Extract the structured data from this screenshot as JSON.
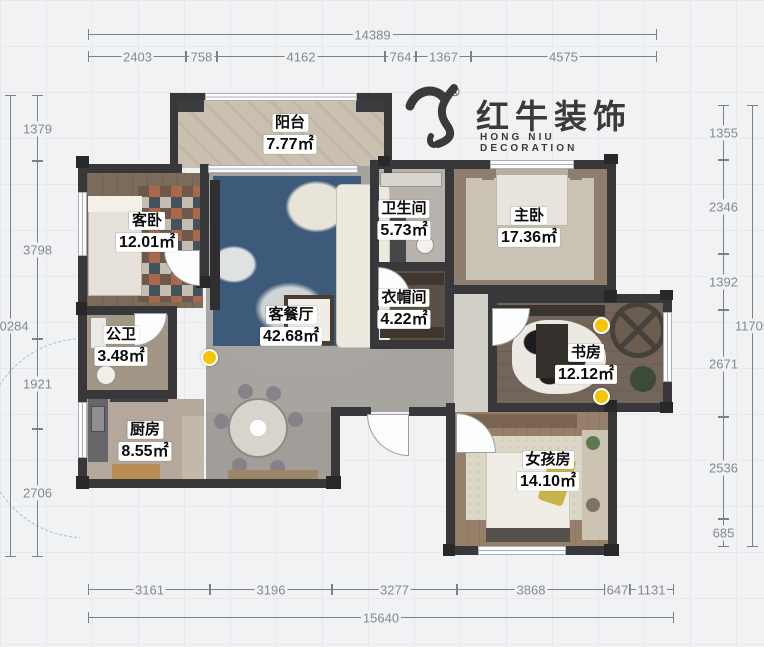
{
  "logo": {
    "brand": "红牛装饰",
    "subtitle": "HONG NIU DECORATION",
    "registered_mark": "®",
    "color": "#3a3a3c"
  },
  "rooms": [
    {
      "name": "阳台",
      "area": "7.77㎡"
    },
    {
      "name": "客卧",
      "area": "12.01㎡"
    },
    {
      "name": "客餐厅",
      "area": "42.68㎡"
    },
    {
      "name": "卫生间",
      "area": "5.73㎡"
    },
    {
      "name": "主卧",
      "area": "17.36㎡"
    },
    {
      "name": "衣帽间",
      "area": "4.22㎡"
    },
    {
      "name": "公卫",
      "area": "3.48㎡"
    },
    {
      "name": "书房",
      "area": "12.12㎡"
    },
    {
      "name": "厨房",
      "area": "8.55㎡"
    },
    {
      "name": "女孩房",
      "area": "14.10㎡"
    }
  ],
  "dimensions": {
    "top": {
      "total": "14389",
      "segments": [
        "2403",
        "758",
        "4162",
        "764",
        "1367",
        "4575"
      ]
    },
    "bottom": {
      "total": "15640",
      "segments": [
        "3161",
        "3196",
        "3277",
        "3868",
        "647",
        "1131"
      ]
    },
    "left": {
      "total": "10284",
      "segments": [
        "1379",
        "3798",
        "1921",
        "2706"
      ]
    },
    "right": {
      "total": "11705",
      "segments": [
        "1355",
        "2346",
        "1392",
        "2671",
        "2536",
        "685"
      ]
    }
  },
  "markers": {
    "count": 3,
    "color": "#f3c503"
  },
  "colors": {
    "wall": "#38383a",
    "background": "#f1f2f3",
    "dimension_text": "#84898f",
    "marker_yellow": "#f3c503"
  }
}
